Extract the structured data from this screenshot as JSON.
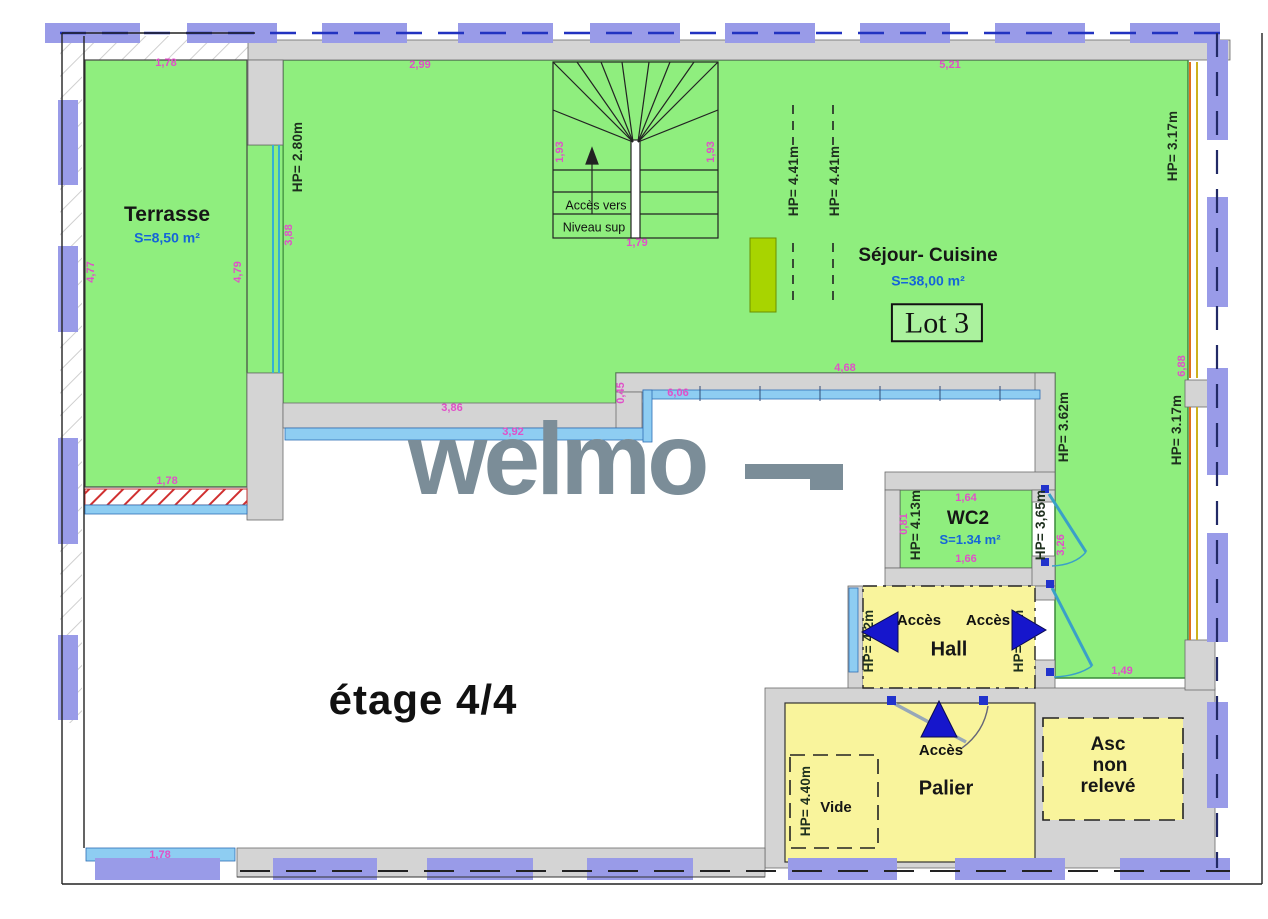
{
  "floor_label": "étage 4/4",
  "watermark": "welmo",
  "lot": "Lot 3",
  "rooms": {
    "terrasse": {
      "name": "Terrasse",
      "area": "S=8,50 m²"
    },
    "sejour_cuisine": {
      "name": "Séjour- Cuisine",
      "area": "S=38,00 m²"
    },
    "wc2": {
      "name": "WC2",
      "area": "S=1.34 m²"
    },
    "hall": {
      "name": "Hall",
      "access_left": "Accès",
      "access_right": "Accès"
    },
    "palier": {
      "name": "Palier",
      "access": "Accès"
    },
    "vide": {
      "name": "Vide"
    },
    "ascenseur": {
      "line1": "Asc",
      "line2": "non",
      "line3": "relevé"
    }
  },
  "stairs": {
    "line1": "Accès vers",
    "line2": "Niveau sup"
  },
  "dim_labels": [
    {
      "t": "1,78",
      "x": 166,
      "y": 64,
      "v": false
    },
    {
      "t": "2,99",
      "x": 420,
      "y": 66,
      "v": false
    },
    {
      "t": "5,21",
      "x": 950,
      "y": 66,
      "v": false
    },
    {
      "t": "4,77",
      "x": 92,
      "y": 272,
      "v": true
    },
    {
      "t": "4,79",
      "x": 239,
      "y": 272,
      "v": true
    },
    {
      "t": "3,88",
      "x": 290,
      "y": 235,
      "v": true
    },
    {
      "t": "1,93",
      "x": 561,
      "y": 152,
      "v": true
    },
    {
      "t": "1,93",
      "x": 712,
      "y": 152,
      "v": true
    },
    {
      "t": "1,79",
      "x": 637,
      "y": 244,
      "v": false
    },
    {
      "t": "1,78",
      "x": 167,
      "y": 482,
      "v": false
    },
    {
      "t": "3,86",
      "x": 452,
      "y": 409,
      "v": false
    },
    {
      "t": "3,92",
      "x": 513,
      "y": 433,
      "v": false
    },
    {
      "t": "4,68",
      "x": 845,
      "y": 369,
      "v": false
    },
    {
      "t": "0,45",
      "x": 622,
      "y": 393,
      "v": true
    },
    {
      "t": "6,06",
      "x": 678,
      "y": 394,
      "v": false
    },
    {
      "t": "6,88",
      "x": 1183,
      "y": 366,
      "v": true
    },
    {
      "t": "1,64",
      "x": 966,
      "y": 499,
      "v": false
    },
    {
      "t": "1,66",
      "x": 966,
      "y": 560,
      "v": false
    },
    {
      "t": "3,26",
      "x": 1062,
      "y": 545,
      "v": true
    },
    {
      "t": "0,81",
      "x": 905,
      "y": 524,
      "v": true
    },
    {
      "t": "1,49",
      "x": 1122,
      "y": 672,
      "v": false
    },
    {
      "t": "1,78",
      "x": 160,
      "y": 856,
      "v": false
    }
  ],
  "hp_labels": [
    {
      "t": "HP= 2.80m",
      "x": 298,
      "y": 157
    },
    {
      "t": "HP= 4.41m",
      "x": 794,
      "y": 181
    },
    {
      "t": "HP= 4.41m",
      "x": 835,
      "y": 181
    },
    {
      "t": "HP= 3.17m",
      "x": 1173,
      "y": 146
    },
    {
      "t": "HP= 3.17m",
      "x": 1177,
      "y": 430
    },
    {
      "t": "HP= 3.62m",
      "x": 1064,
      "y": 427
    },
    {
      "t": "HP= 4.13m",
      "x": 916,
      "y": 525
    },
    {
      "t": "HP= 3,65m",
      "x": 1041,
      "y": 525
    },
    {
      "t": "HP= 4.2m",
      "x": 869,
      "y": 641
    },
    {
      "t": "HP= 3.6m",
      "x": 1019,
      "y": 641
    },
    {
      "t": "HP= 4.40m",
      "x": 806,
      "y": 801
    }
  ],
  "colors": {
    "room_green": "#8fee7e",
    "room_yellow": "#f9f49c",
    "wall_gray": "#d4d4d4",
    "railing_blue": "#8ecdf2",
    "border_purple": "#999be8",
    "dimension_pink": "#e050c8",
    "area_blue": "#1565d8",
    "arrow_blue": "#1616cc",
    "kitchen_lime": "#a8d400",
    "watermark_gray": "#7b8d98"
  }
}
